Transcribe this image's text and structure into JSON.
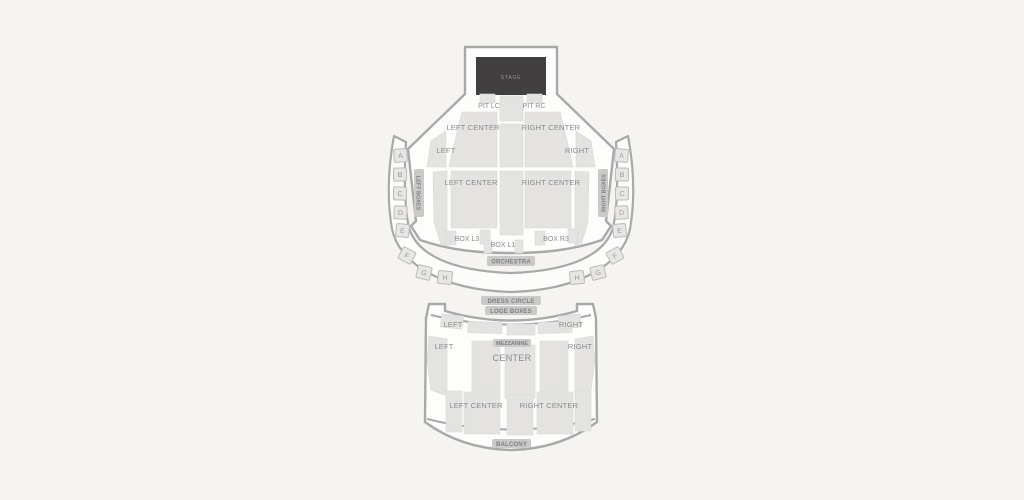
{
  "colors": {
    "background": "#f5f4f1",
    "venue_fill": "#fdfdfc",
    "outline": "#a9a9a9",
    "section_fill": "#e4e3e1",
    "stage_fill": "#413f3f",
    "label_text": "#8b8b8b",
    "chip_bg": "#cbcac8",
    "chip_text": "#7e7e81"
  },
  "stage": {
    "label": "STAGE"
  },
  "orchestra": {
    "pit_lc": "PIT LC",
    "pit_rc": "PIT RC",
    "front_left_center": "LEFT CENTER",
    "front_right_center": "RIGHT CENTER",
    "front_left": "LEFT",
    "front_right": "RIGHT",
    "rear_left_center": "LEFT CENTER",
    "rear_right_center": "RIGHT CENTER",
    "box_l3": "BOX L3",
    "box_l1": "BOX L1",
    "box_r3": "BOX R3",
    "label": "ORCHESTRA",
    "left_boxes_title": "LEFT BOXES",
    "right_boxes_title": "RIGHT BOXES",
    "left_letters": [
      "A",
      "B",
      "C",
      "D",
      "E",
      "F",
      "G",
      "H"
    ],
    "right_letters": [
      "A",
      "B",
      "C",
      "D",
      "E",
      "F",
      "G",
      "H"
    ]
  },
  "circle": {
    "dress_circle": "DRESS CIRCLE",
    "loge_boxes": "LOGE BOXES"
  },
  "balcony": {
    "loge_left": "LEFT",
    "loge_right": "RIGHT",
    "mezz_left": "LEFT",
    "mezz_right": "RIGHT",
    "mezzanine": "MEZZANINE",
    "center": "CENTER",
    "rear_left_center": "LEFT CENTER",
    "rear_right_center": "RIGHT CENTER",
    "label": "BALCONY"
  }
}
